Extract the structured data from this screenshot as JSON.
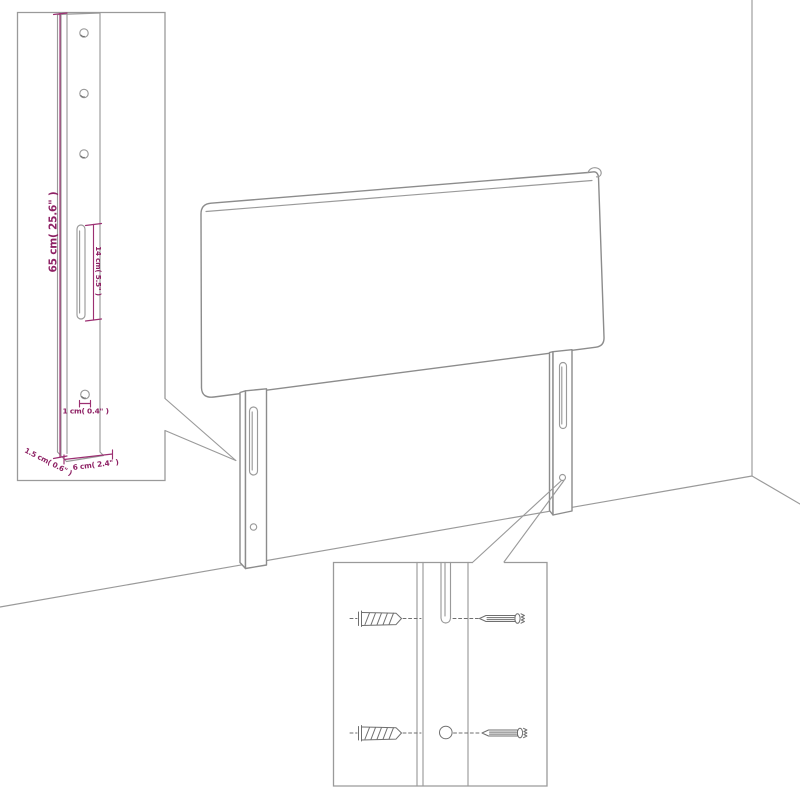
{
  "diagram": {
    "title": "headboard-mounting-dimension-diagram",
    "colors": {
      "accent": "#8e2164",
      "dimension_line": "#9c2f72",
      "outline": "#8c8c8c",
      "background": "#ffffff"
    },
    "labels": {
      "height": "65 cm( 25.6\" )",
      "slot": "14 cm( 5.5\" )",
      "hole": "1 cm( 0.4\" )",
      "depth": "1.5 cm( 0.6\" )",
      "width": "6 cm( 2.4\" )"
    }
  }
}
